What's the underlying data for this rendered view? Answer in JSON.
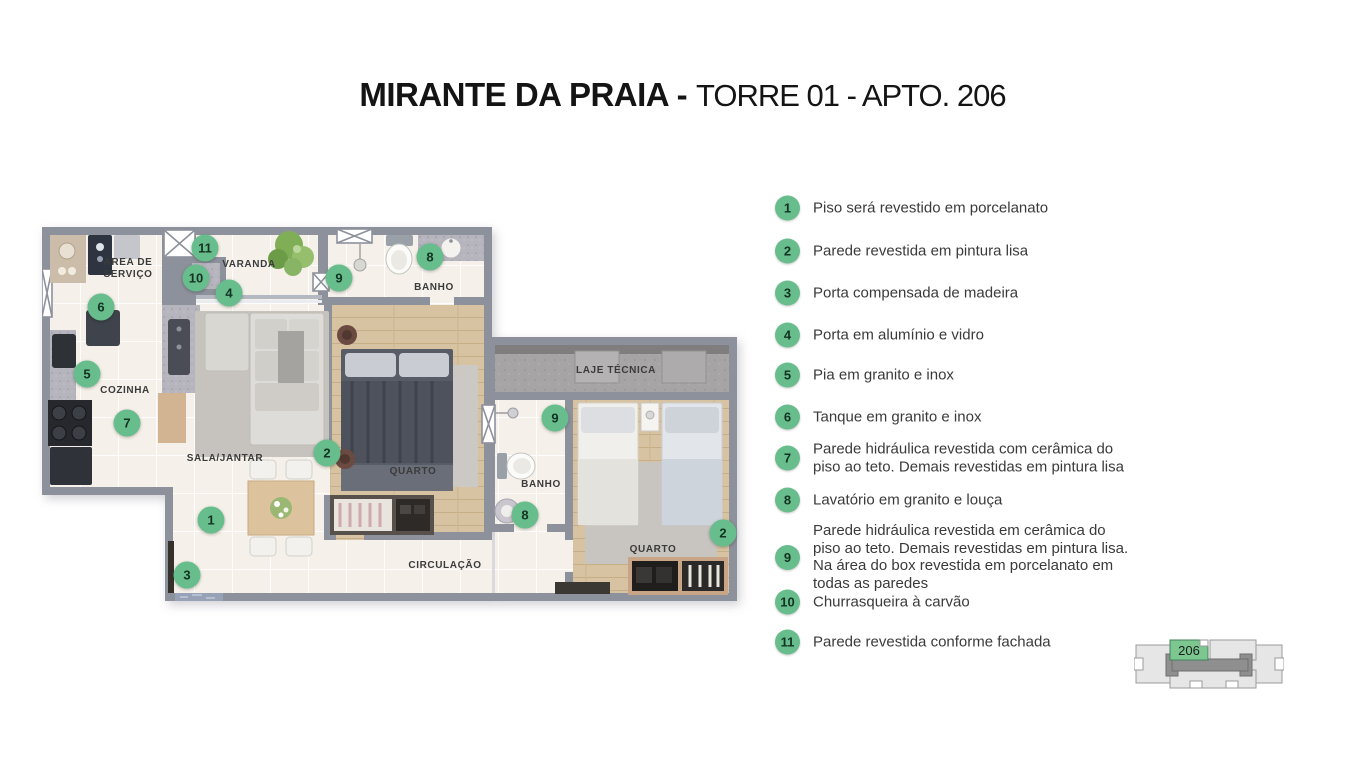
{
  "title": {
    "bold": "MIRANTE DA PRAIA -",
    "regular": "TORRE 01 - APTO. 206"
  },
  "colors": {
    "marker_green": "#67bd8b",
    "wall_gray": "#8d919b",
    "footprint_green": "#7cc68f"
  },
  "legend": {
    "items": [
      {
        "n": "1",
        "y": 208,
        "lines": [
          "Piso será revestido em porcelanato"
        ]
      },
      {
        "n": "2",
        "y": 251,
        "lines": [
          "Parede revestida em pintura lisa"
        ]
      },
      {
        "n": "3",
        "y": 293,
        "lines": [
          "Porta compensada de madeira"
        ]
      },
      {
        "n": "4",
        "y": 335,
        "lines": [
          "Porta em alumínio e vidro"
        ]
      },
      {
        "n": "5",
        "y": 375,
        "lines": [
          "Pia em granito e inox"
        ]
      },
      {
        "n": "6",
        "y": 417,
        "lines": [
          "Tanque em granito e inox"
        ]
      },
      {
        "n": "7",
        "y": 458,
        "lines": [
          "Parede hidráulica revestida com cerâmica do",
          "piso ao teto. Demais revestidas em pintura lisa"
        ]
      },
      {
        "n": "8",
        "y": 500,
        "lines": [
          "Lavatório em granito e louça"
        ]
      },
      {
        "n": "9",
        "y": 557,
        "lines": [
          "Parede hidráulica revestida em cerâmica do",
          "piso ao teto. Demais revestidas em pintura lisa.",
          "Na área do box revestida em porcelanato em",
          "todas as paredes"
        ]
      },
      {
        "n": "10",
        "y": 602,
        "lines": [
          "Churrasqueira à carvão"
        ]
      },
      {
        "n": "11",
        "y": 642,
        "lines": [
          "Parede revestida conforme fachada"
        ]
      }
    ]
  },
  "plan": {
    "rooms": [
      {
        "lines": [
          "ÁREA DE",
          "SERVIÇO"
        ],
        "x": 86,
        "y": 42
      },
      {
        "lines": [
          "VARANDA"
        ],
        "x": 207,
        "y": 38
      },
      {
        "lines": [
          "BANHO"
        ],
        "x": 392,
        "y": 61
      },
      {
        "lines": [
          "COZINHA"
        ],
        "x": 83,
        "y": 164
      },
      {
        "lines": [
          "SALA/JANTAR"
        ],
        "x": 183,
        "y": 232
      },
      {
        "lines": [
          "QUARTO"
        ],
        "x": 371,
        "y": 245
      },
      {
        "lines": [
          "LAJE TÉCNICA"
        ],
        "x": 574,
        "y": 144
      },
      {
        "lines": [
          "BANHO"
        ],
        "x": 499,
        "y": 258
      },
      {
        "lines": [
          "QUARTO"
        ],
        "x": 611,
        "y": 323
      },
      {
        "lines": [
          "CIRCULAÇÃO"
        ],
        "x": 403,
        "y": 339
      }
    ],
    "markers": [
      {
        "n": "11",
        "x": 163,
        "y": 21
      },
      {
        "n": "10",
        "x": 154,
        "y": 51
      },
      {
        "n": "4",
        "x": 187,
        "y": 66
      },
      {
        "n": "6",
        "x": 59,
        "y": 80
      },
      {
        "n": "9",
        "x": 297,
        "y": 51
      },
      {
        "n": "8",
        "x": 388,
        "y": 30
      },
      {
        "n": "5",
        "x": 45,
        "y": 147
      },
      {
        "n": "7",
        "x": 85,
        "y": 196
      },
      {
        "n": "2",
        "x": 285,
        "y": 226
      },
      {
        "n": "1",
        "x": 169,
        "y": 293
      },
      {
        "n": "3",
        "x": 145,
        "y": 348
      },
      {
        "n": "9",
        "x": 513,
        "y": 191
      },
      {
        "n": "8",
        "x": 483,
        "y": 288
      },
      {
        "n": "2",
        "x": 681,
        "y": 306
      }
    ]
  },
  "footprint": {
    "unit_label": "206"
  }
}
